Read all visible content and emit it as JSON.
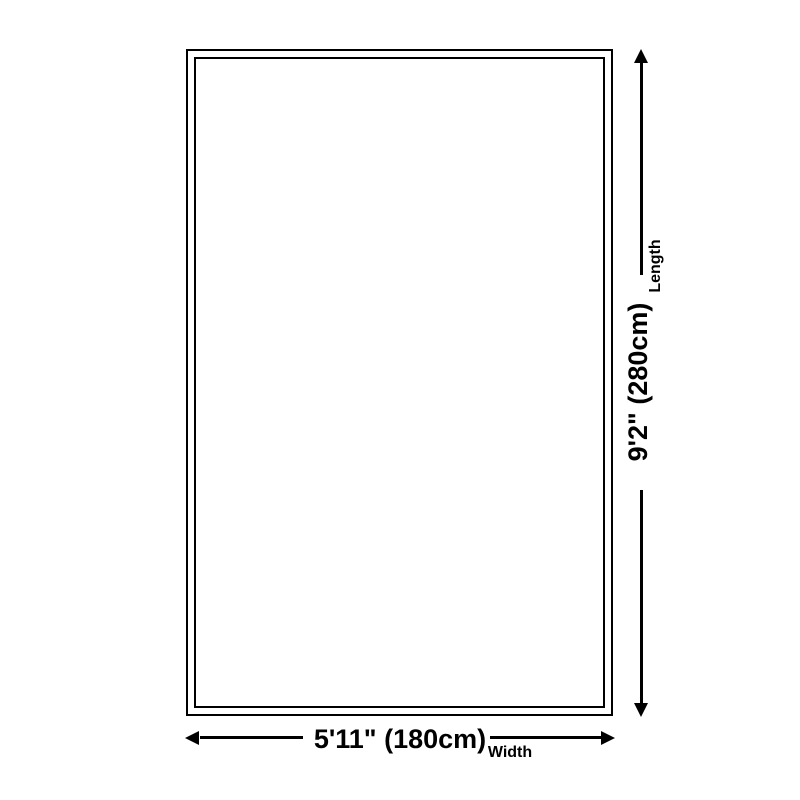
{
  "page": {
    "background_color": "#ffffff",
    "line_color": "#000000",
    "text_color": "#000000"
  },
  "diagram": {
    "type": "rug-size-dimension-diagram",
    "rug": {
      "shape": "rectangle",
      "outline_style": "double-border"
    },
    "dimensions": {
      "length": {
        "value": "9'2\" (280cm)",
        "label": "Length"
      },
      "width": {
        "value": "5'11\" (180cm)",
        "label": "Width"
      }
    }
  }
}
